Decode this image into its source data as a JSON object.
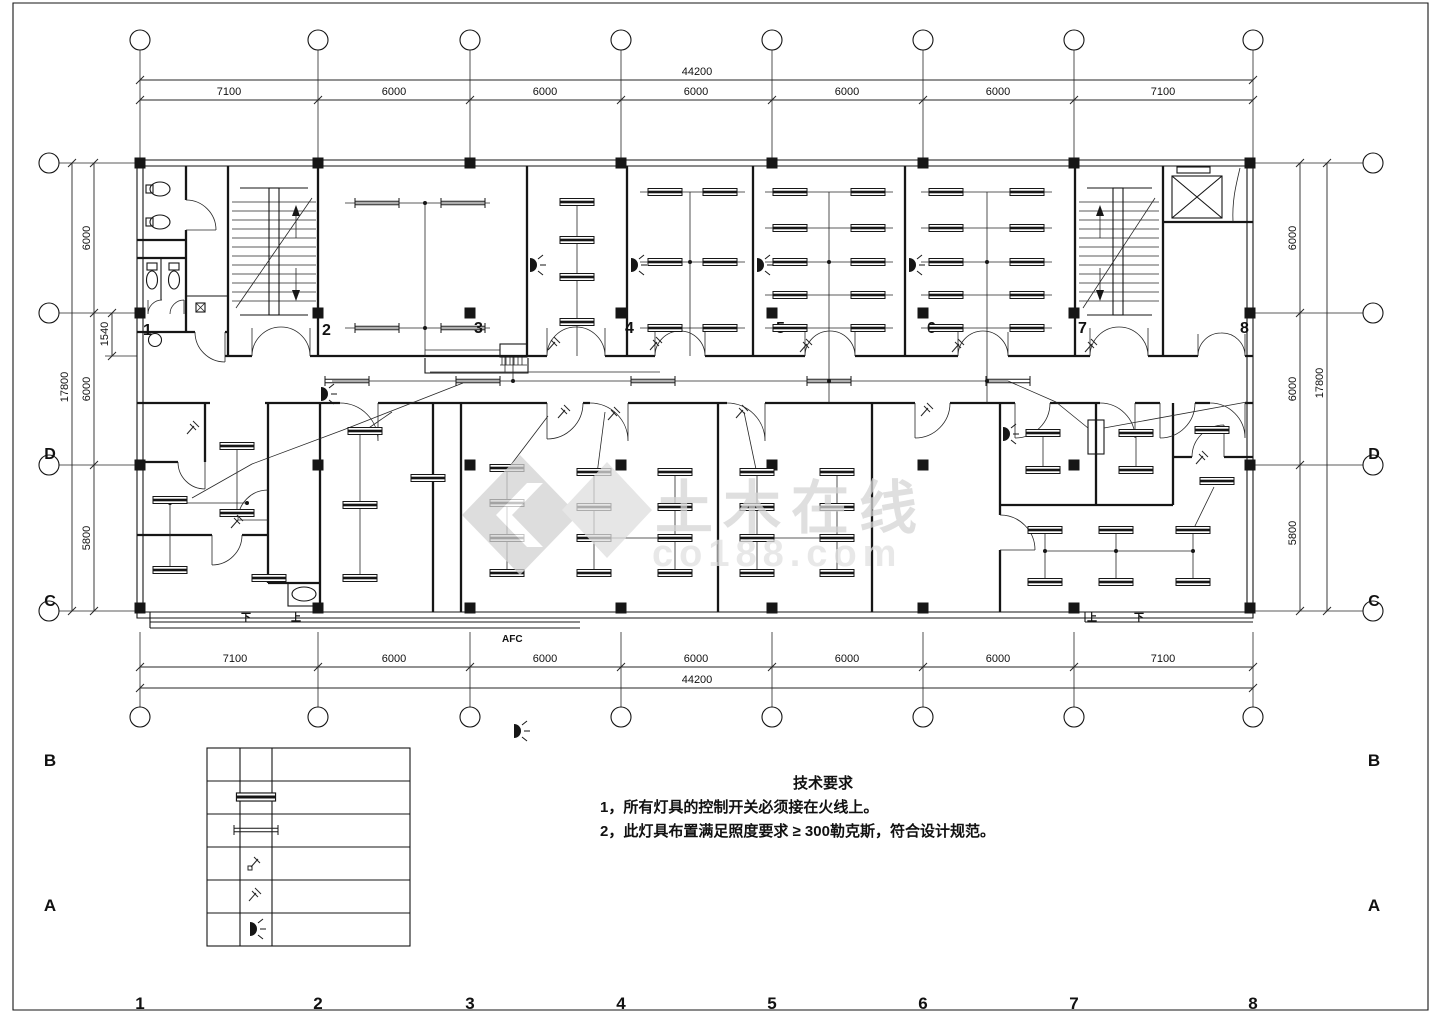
{
  "colors": {
    "background": "#ffffff",
    "line": "#161616",
    "watermark_gray": "#d5d5d5"
  },
  "frame": {
    "grid_numbers": [
      "1",
      "2",
      "3",
      "4",
      "5",
      "6",
      "7",
      "8"
    ],
    "left_letters": [
      "B",
      "A"
    ],
    "right_letters": [
      "B",
      "A"
    ]
  },
  "axes": {
    "left": [
      "D",
      "C"
    ],
    "right": [
      "D",
      "C"
    ]
  },
  "dimensions": {
    "top": {
      "total": "44200",
      "segments": [
        "7100",
        "6000",
        "6000",
        "6000",
        "6000",
        "6000",
        "7100"
      ]
    },
    "bottom": {
      "total": "44200",
      "segments": [
        "7100",
        "6000",
        "6000",
        "6000",
        "6000",
        "6000",
        "7100"
      ]
    },
    "left": {
      "total": "17800",
      "segments": [
        "6000",
        "6000",
        "5800"
      ],
      "inner": "1540"
    },
    "right": {
      "total": "17800",
      "segments": [
        "6000",
        "6000",
        "5800"
      ]
    }
  },
  "plan": {
    "column_numbers": [
      "1",
      "2",
      "3",
      "4",
      "5",
      "6",
      "7",
      "8"
    ],
    "panel_label": "AFC",
    "stair_dir_left": {
      "down": "下",
      "up": "上"
    },
    "stair_dir_right": {
      "up": "上",
      "down": "下"
    }
  },
  "notes": {
    "title": "技术要求",
    "item1": "1，所有灯具的控制开关必须接在火线上。",
    "item2": "2，此灯具布置满足照度要求 ≥ 300勒克斯，符合设计规范。"
  },
  "watermark": {
    "brand": "土木在线",
    "domain": "co188.com"
  },
  "legend": {
    "row_symbols": [
      "",
      "double-tube-fluorescent-light",
      "single-tube-fluorescent-light",
      "single-pole-switch",
      "two-pole-switch",
      "wall-lamp"
    ]
  }
}
